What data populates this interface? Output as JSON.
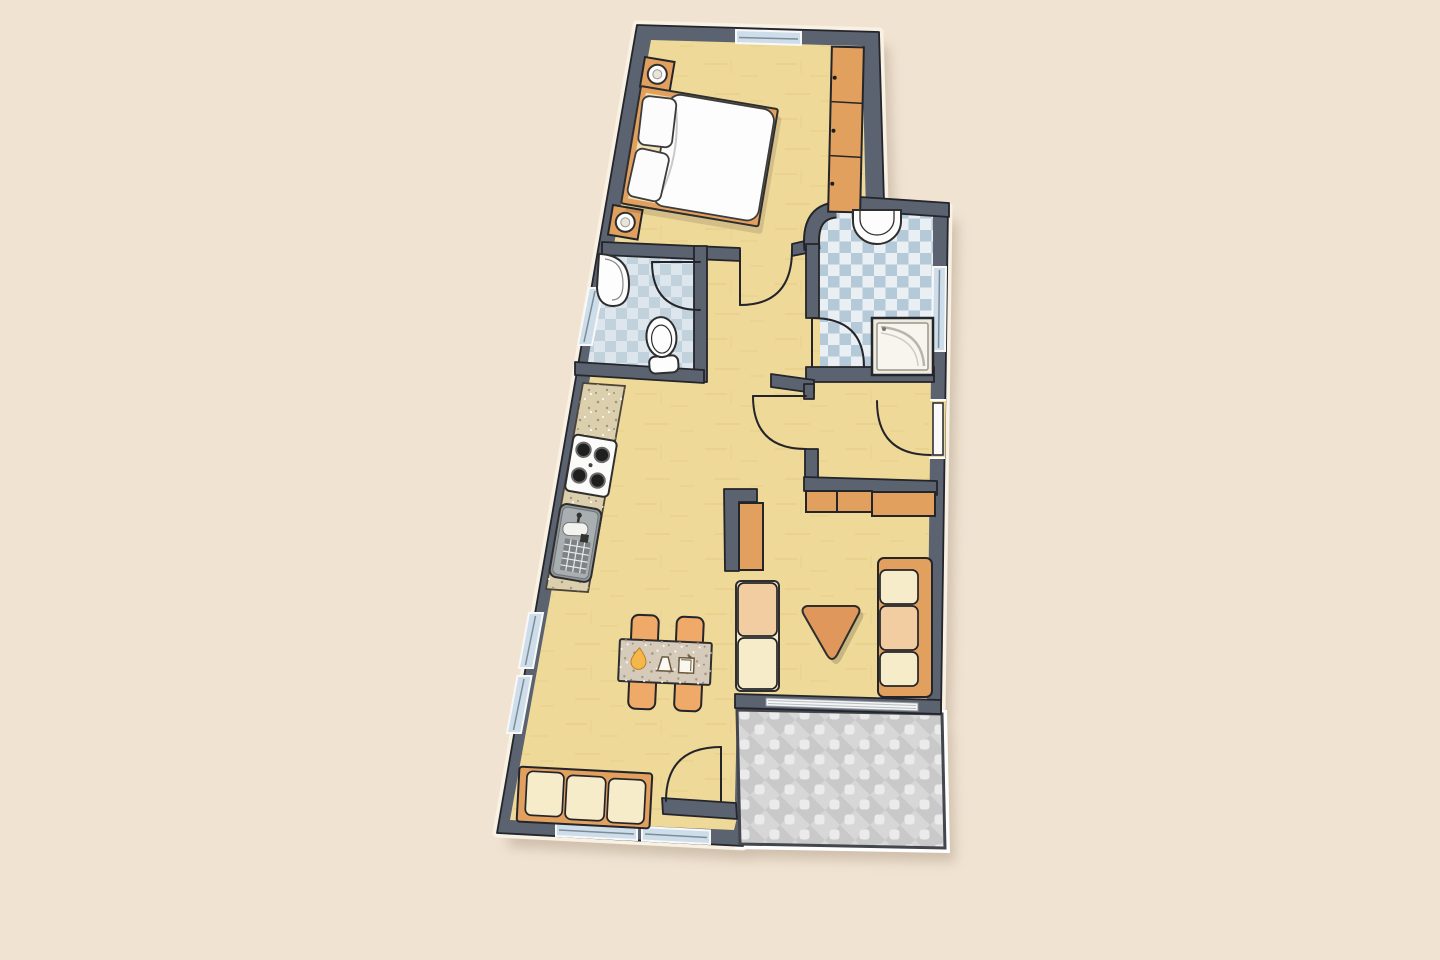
{
  "title": "apartment-floor-plan",
  "palette": {
    "bg": "#f1e3d2",
    "wall": "#5b6270",
    "ink": "#23252a",
    "floor": "#efd999",
    "grain": "#d9b869",
    "tb": "#b5cad8",
    "tl": "#e9eff3",
    "wtb": "#c2d2dc",
    "wtl": "#dde6ec",
    "terr": "#c9c9c9",
    "terrd": "#d7d7d7",
    "puff": "#ebebeb",
    "or": "#e2a05f",
    "orl": "#efa968",
    "cream": "#f6ecca",
    "peach": "#f2cda2",
    "cnt": "#dbcfae",
    "win": "#cddeea",
    "white": "#fdfdfd",
    "gray": "#8f9598",
    "halo": "#f8f1e4"
  },
  "rooms": [
    {
      "id": "bedroom",
      "floor": "wood-yellow",
      "furniture": [
        "double-bed",
        "two-pillows",
        "duvet",
        "nightstand-with-lamp-top",
        "nightstand-with-lamp-bottom",
        "wardrobe-3-sections"
      ],
      "windows": [
        "top-wall-window"
      ]
    },
    {
      "id": "wc",
      "floor": "blue-checker-tile",
      "furniture": [
        "corner-washbasin",
        "toilet"
      ],
      "windows": [
        "left-wall-window"
      ]
    },
    {
      "id": "bathroom",
      "floor": "blue-checker-tile",
      "furniture": [
        "washbasin",
        "shower-cabin"
      ],
      "windows": [
        "right-wall-window"
      ],
      "features": [
        "rounded-corner-wall"
      ]
    },
    {
      "id": "hallway",
      "floor": "wood-yellow",
      "furniture": []
    },
    {
      "id": "entry-vestibule",
      "floor": "wood-yellow",
      "furniture": [
        "sideboard-3-sections"
      ],
      "doors": [
        "entrance-door-right-wall"
      ]
    },
    {
      "id": "living-kitchen",
      "floor": "wood-yellow",
      "furniture": [
        "kitchen-counter",
        "stove-4-burners",
        "kitchen-sink",
        "dining-table",
        "4-chairs",
        "sofa-3-seat-bottom",
        "sofa-2-seat",
        "sofa-3-seat-right",
        "triangle-coffee-table",
        "tall-cabinet"
      ],
      "windows": [
        "left-wall-window-2-segments",
        "bottom-wall-window-1",
        "bottom-wall-window-2"
      ]
    },
    {
      "id": "terrace",
      "floor": "gray-diamond-tile",
      "furniture": [],
      "features": [
        "sliding-glass-door"
      ]
    }
  ],
  "doors": [
    "bedroom-door",
    "wc-door",
    "bathroom-door",
    "vestibule-door",
    "entrance-door",
    "terrace-door"
  ],
  "table_decor": [
    "yellow-teardrop",
    "small-lamp-glyph",
    "small-box-glyph"
  ]
}
